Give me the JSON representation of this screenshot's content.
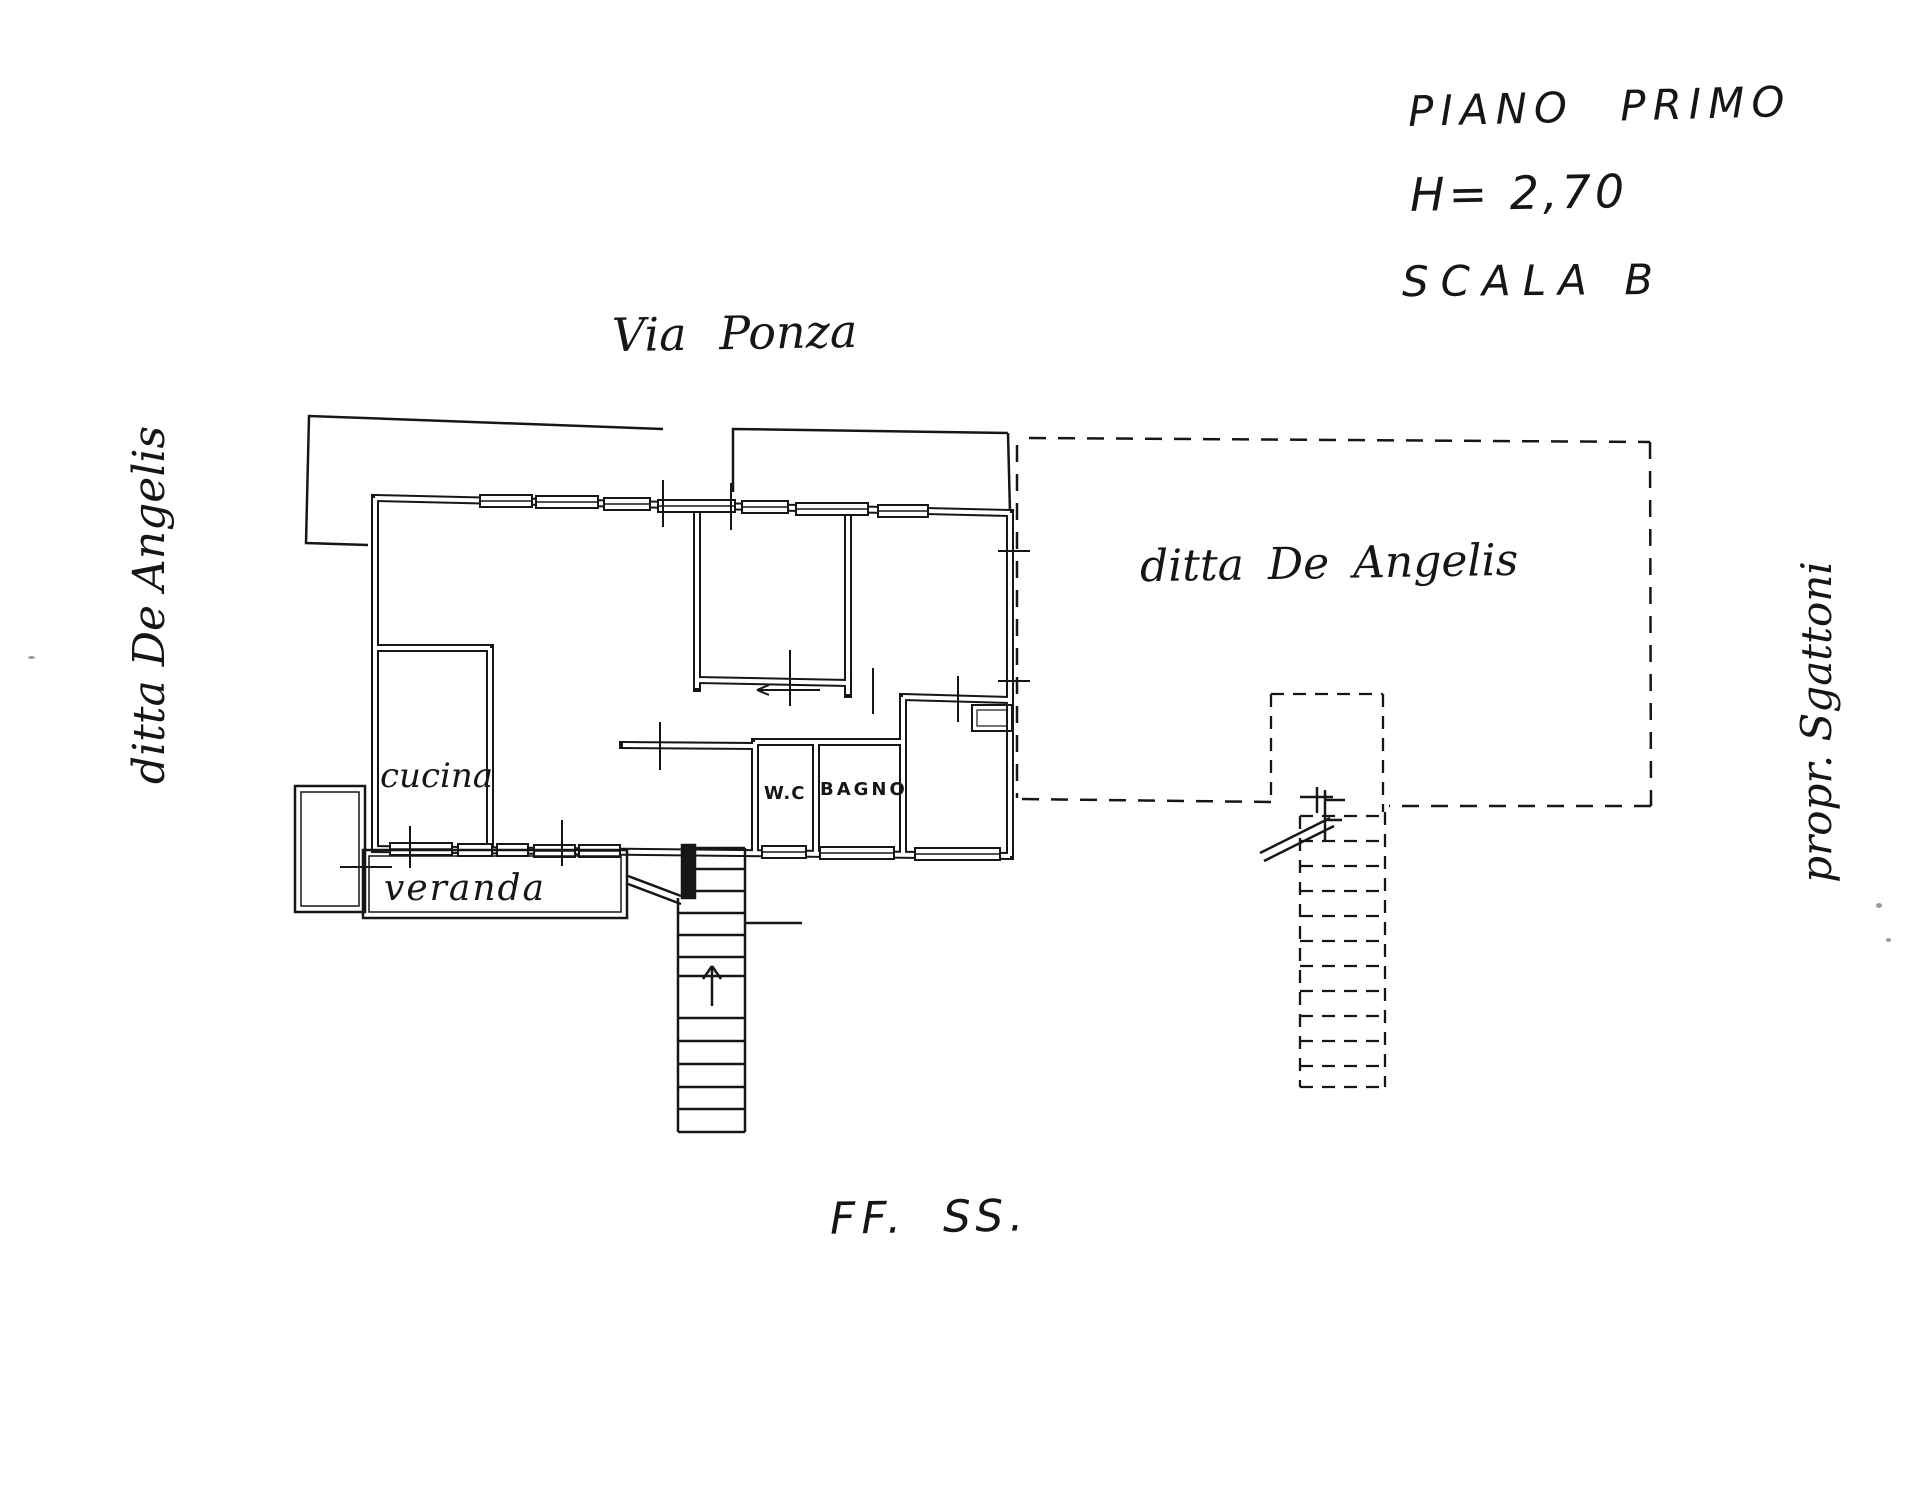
{
  "page": {
    "background": "#ffffff",
    "ink": "#161616"
  },
  "title_block": {
    "floor": "PIANO PRIMO",
    "height": "H= 2,70",
    "stair": "SCALA B"
  },
  "context_labels": {
    "street_top": "Via Ponza",
    "neighbor_left": "ditta De Angelis",
    "neighbor_area_right": "ditta De Angelis",
    "owner_right": "propr. Sgattoni",
    "railway_bottom": "FF. SS."
  },
  "room_labels": {
    "kitchen": "cucina",
    "wc": "W.C",
    "bathroom": "BAGNO",
    "veranda": "veranda"
  }
}
